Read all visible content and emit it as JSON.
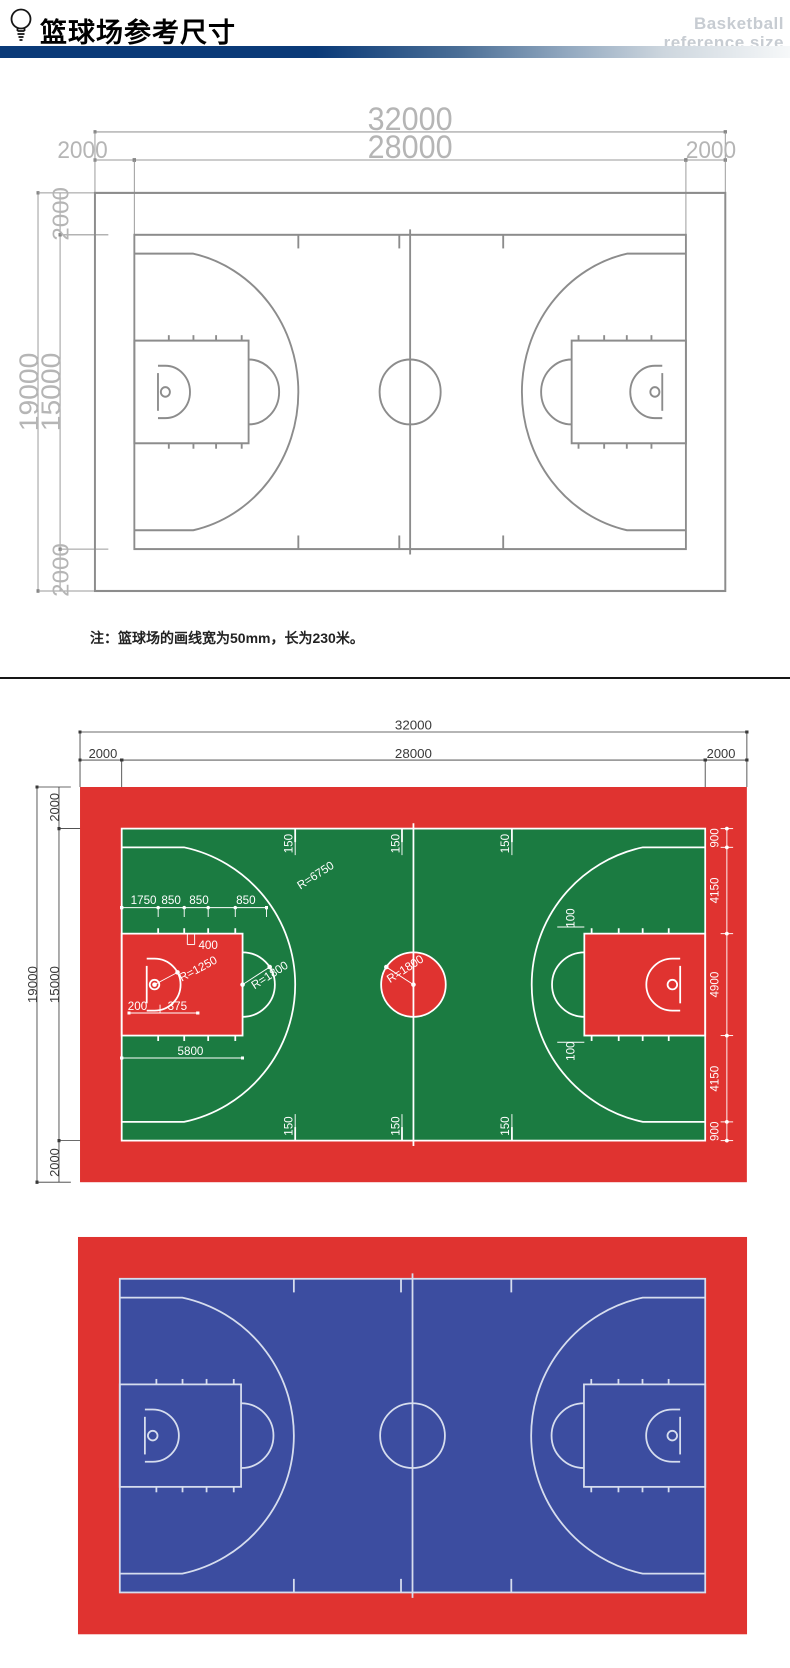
{
  "header": {
    "title": "篮球场参考尺寸",
    "subtitle_line1": "Basketball",
    "subtitle_line2": "reference size"
  },
  "note": "注：篮球场的画线宽为50mm，长为230米。",
  "colors": {
    "red": "#e03330",
    "green": "#1b7b41",
    "blue": "#3c4da0",
    "court_line_gray": "#8c8c8c",
    "court_line_light": "#d6ddee",
    "dim_text_gray": "#b5b5b5",
    "dim_line_gray": "#9a9a9a",
    "dim_dark": "#3a3a3a",
    "navy_bar": "#0a3a78",
    "white": "#ffffff"
  },
  "dims": {
    "total_width": "32000",
    "court_width": "28000",
    "margin": "2000",
    "total_height": "19000",
    "court_height": "15000"
  },
  "court_labels": {
    "side_offsets": [
      "900",
      "4150",
      "4900",
      "4150",
      "900"
    ],
    "line_mark": "150",
    "hash_mark": "100",
    "chain": [
      "1750",
      "850",
      "850",
      "850"
    ],
    "neutral_zone": "400",
    "board_offset": "200",
    "rim_offset": "375",
    "key_length": "5800",
    "three_point_radius": "R=6750",
    "no_charge_radius": "R=1250",
    "free_throw_radius": "R=1800",
    "center_circle_radius": "R=1800"
  }
}
